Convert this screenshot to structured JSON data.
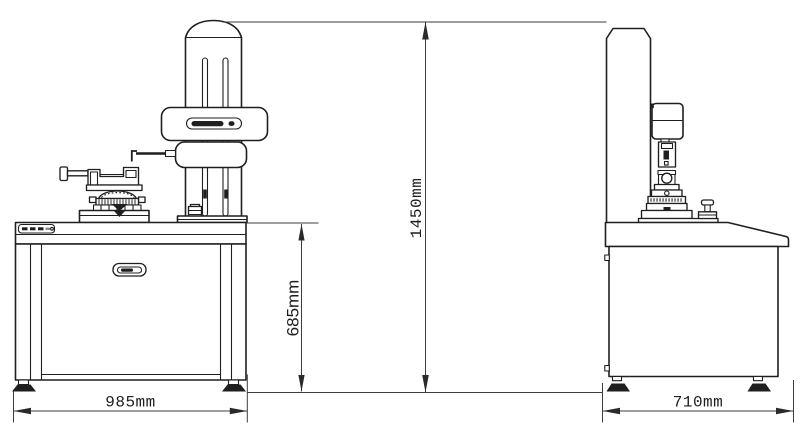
{
  "drawing": {
    "subject": "roundness measuring instrument outline drawing",
    "views": {
      "front": "front-view",
      "side": "side-view"
    },
    "colors": {
      "background": "#ffffff",
      "outline": "#1f1f1f",
      "dimension_line": "#3d3d3d"
    },
    "dimensions": {
      "front_width": {
        "label": "985mm",
        "orientation": "horizontal"
      },
      "side_depth": {
        "label": "710mm",
        "orientation": "horizontal"
      },
      "table_height": {
        "label": "685mm",
        "orientation": "vertical"
      },
      "total_height": {
        "label": "1450mm",
        "orientation": "vertical"
      }
    }
  }
}
